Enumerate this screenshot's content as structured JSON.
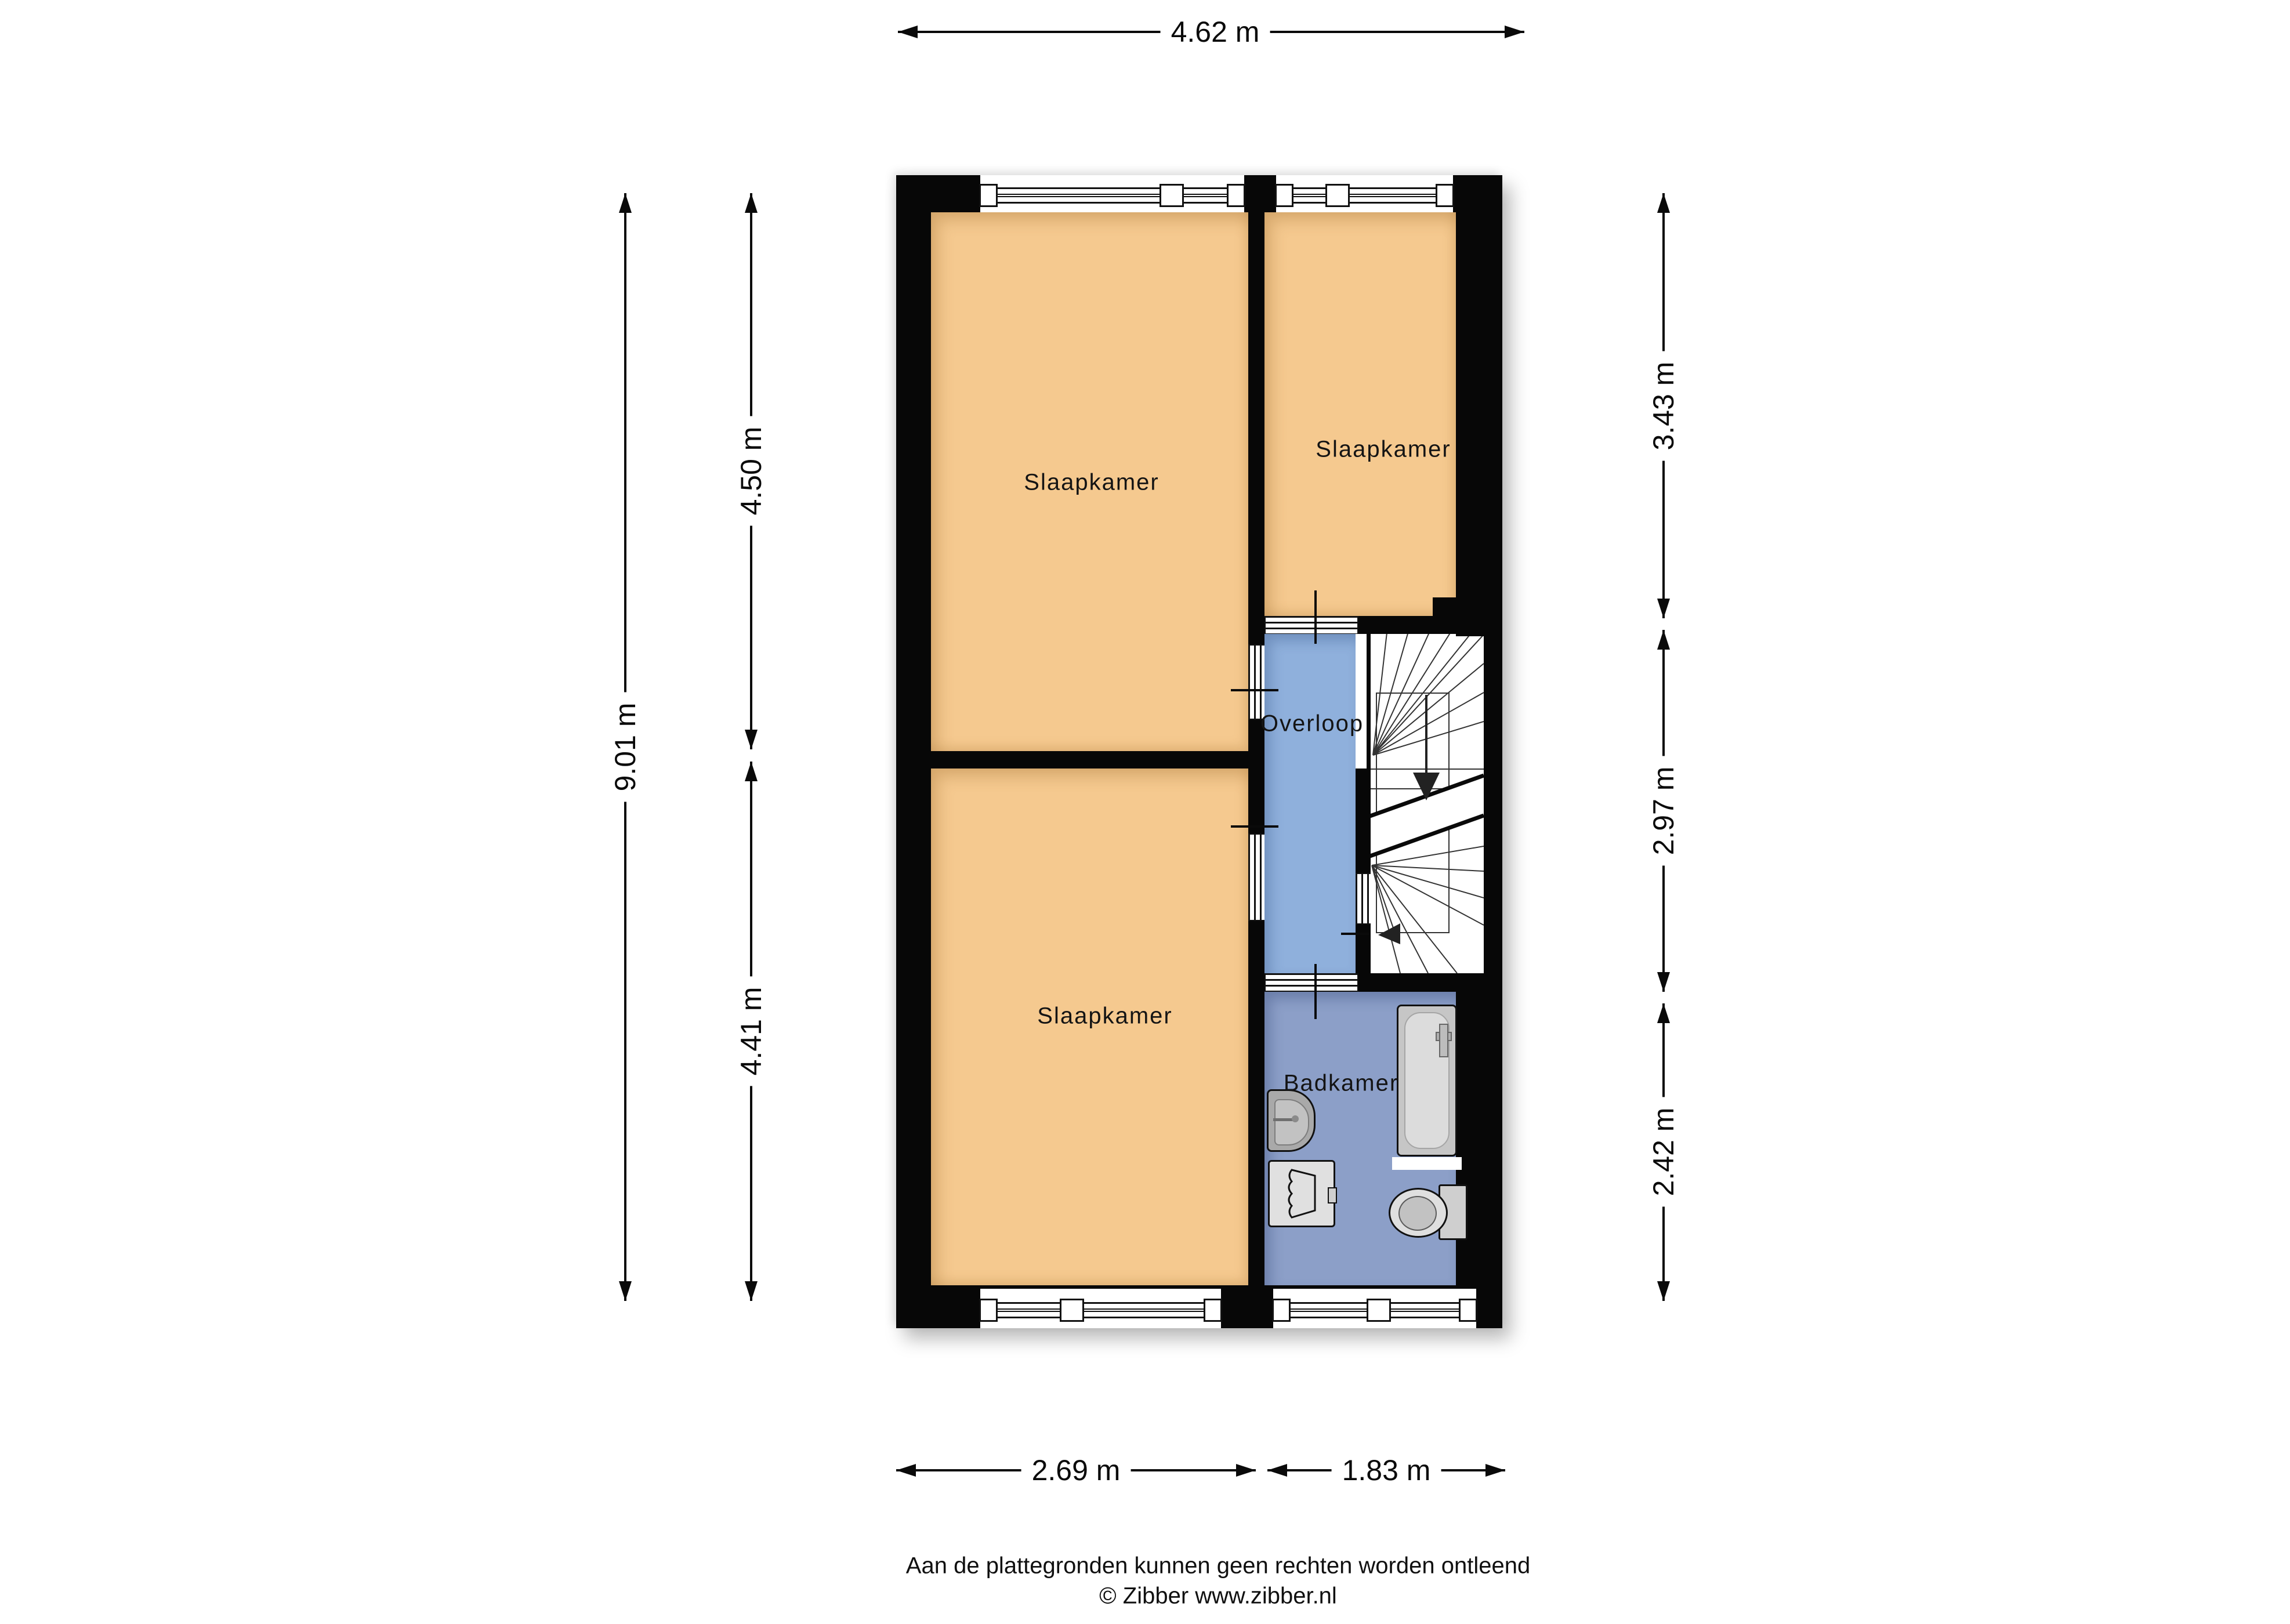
{
  "rooms": [
    {
      "id": "slaapkamer-top-left",
      "label": "Slaapkamer"
    },
    {
      "id": "slaapkamer-top-right",
      "label": "Slaapkamer"
    },
    {
      "id": "slaapkamer-bottom-left",
      "label": "Slaapkamer"
    },
    {
      "id": "overloop",
      "label": "Overloop"
    },
    {
      "id": "badkamer",
      "label": "Badkamer"
    }
  ],
  "dimensions": {
    "top_width": "4.62 m",
    "left_total": "9.01 m",
    "left_upper": "4.50 m",
    "left_lower": "4.41 m",
    "right_upper": "3.43 m",
    "right_middle": "2.97 m",
    "right_lower": "2.42 m",
    "bottom_left": "2.69 m",
    "bottom_right": "1.83 m"
  },
  "fixtures": [
    "bathtub",
    "sink",
    "shower",
    "toilet",
    "staircase",
    "windows",
    "doors"
  ],
  "footer": {
    "disclaimer": "Aan de plattegronden kunnen geen rechten worden ontleend",
    "copyright": "© Zibber www.zibber.nl"
  },
  "colors": {
    "bedroom": "#f5c98f",
    "landing": "#8fb0dc",
    "bathroom": "#8c9fc8",
    "wall": "#070707"
  }
}
